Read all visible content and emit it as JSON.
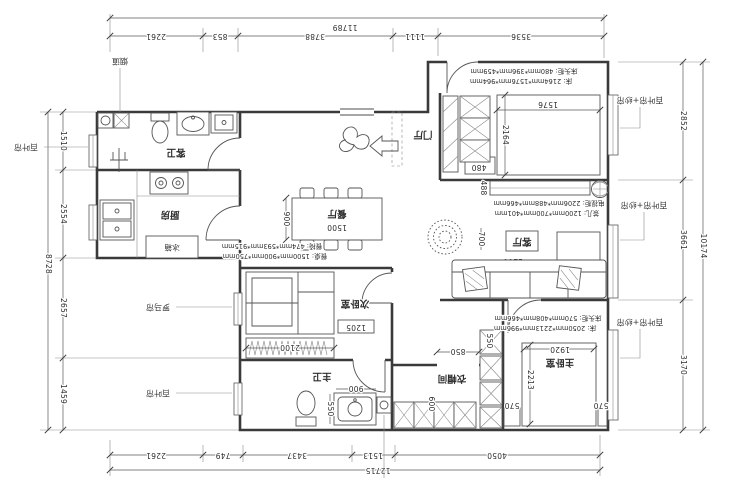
{
  "meta": {
    "type": "residential floor plan",
    "orientation": "rotated-180"
  },
  "labels": {
    "flue": "烟道",
    "blind_left_top": "百叶帘",
    "roman_shade": "罗马帘",
    "blind_left_bottom": "百叶帘",
    "blind_sheer_1": "百叶帘+纱帘",
    "blind_sheer_2": "百叶帘+纱帘",
    "blind_sheer_3": "百叶帘+纱帘",
    "entry_hall": "门厅",
    "guest_bath": "客卫",
    "kitchen": "厨房",
    "fridge": "冰箱",
    "dining": "餐厅",
    "living": "客厅",
    "second_bedroom": "次卧室",
    "master_bedroom": "主卧室",
    "master_bath": "主卫",
    "cloakroom": "衣帽间"
  },
  "annotations": {
    "bed2_nightstand": "床头柜: 480mm*396mm*459mm",
    "bed2": "床: 2164mm*1576mm*964mm",
    "tv_cabinet": "电视柜: 2206mm*488mm*466mm",
    "tea_table": "茶几: 1200mm*700mm*401mm",
    "dining_chair": "餐椅: 474mm*593mm*915mm",
    "dining_table": "餐桌: 1500mm*900mm*750mm",
    "master_nightstand": "床头柜: 570mm*408mm*466mm",
    "master_bed": "床: 2050mm*2213mm*996mm"
  },
  "dims": {
    "top_total": "11789",
    "top": [
      "2261",
      "853",
      "3788",
      "1111",
      "3536"
    ],
    "bottom": [
      "2261",
      "749",
      "3437",
      "1513",
      "4050"
    ],
    "bottom_total": "12715",
    "left": [
      "1510",
      "2554",
      "2657",
      "1459"
    ],
    "left_total": "8728",
    "right": [
      "2852",
      "3661",
      "3170"
    ],
    "right_total": "10174",
    "plan": {
      "d1500": "1500",
      "d900_dining": "900",
      "d1576": "1576",
      "d2164": "2164",
      "d480": "480",
      "d488": "488",
      "d700": "700",
      "d1200": "1200",
      "d1920": "1920",
      "d2213": "2213",
      "d570_l": "570",
      "d570_r": "570",
      "d900_bath": "900",
      "d550_bath": "550",
      "d550_closet": "550",
      "d600": "600",
      "d850": "850",
      "d2100": "2100",
      "d1205": "1205"
    }
  }
}
